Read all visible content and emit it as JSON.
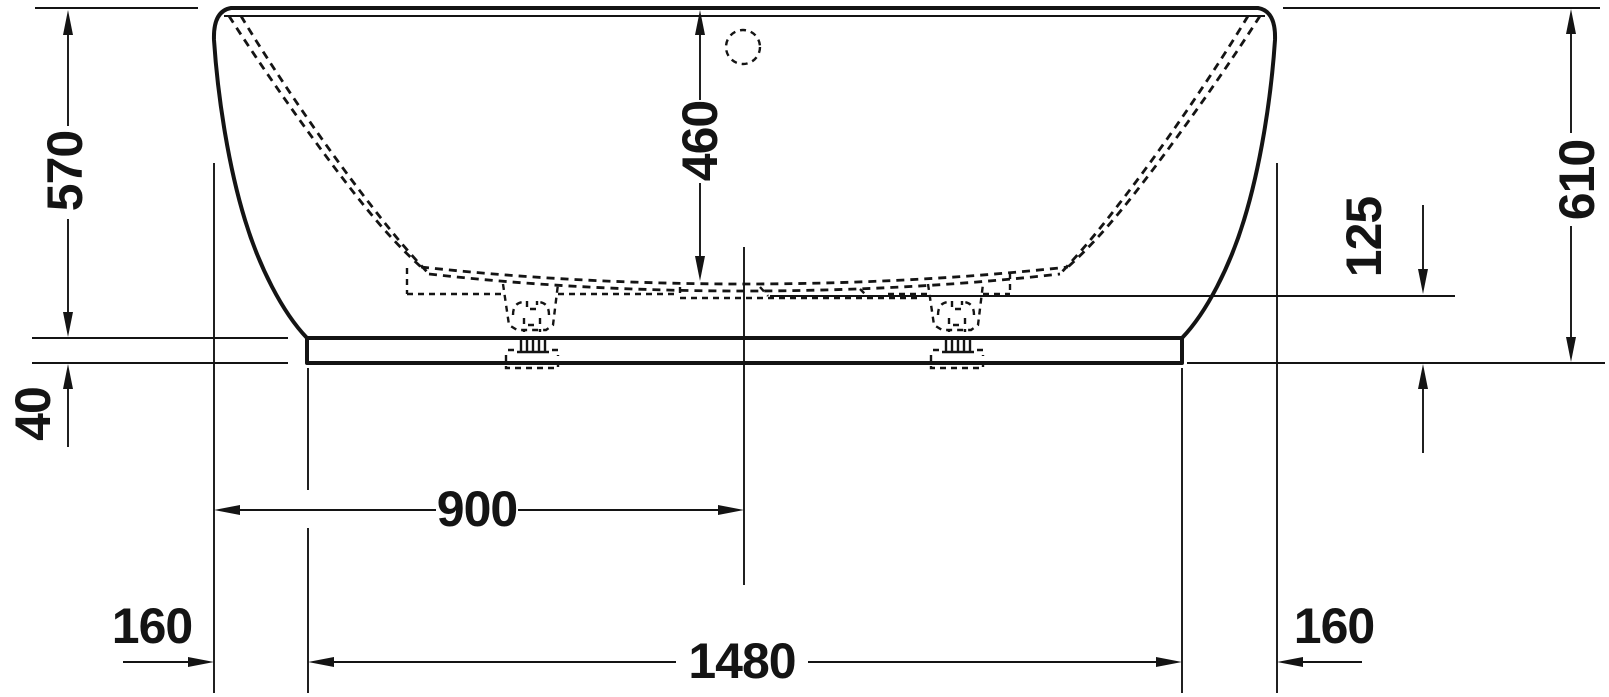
{
  "drawing": {
    "colors": {
      "ink": "#141414",
      "background": "#ffffff"
    },
    "dimensions": {
      "height_left": "570",
      "base_height": "40",
      "inner_depth": "460",
      "center_from_left": "900",
      "left_overhang": "160",
      "base_length": "1480",
      "right_overhang": "160",
      "bottom_clearance": "125",
      "height_right": "610"
    }
  }
}
